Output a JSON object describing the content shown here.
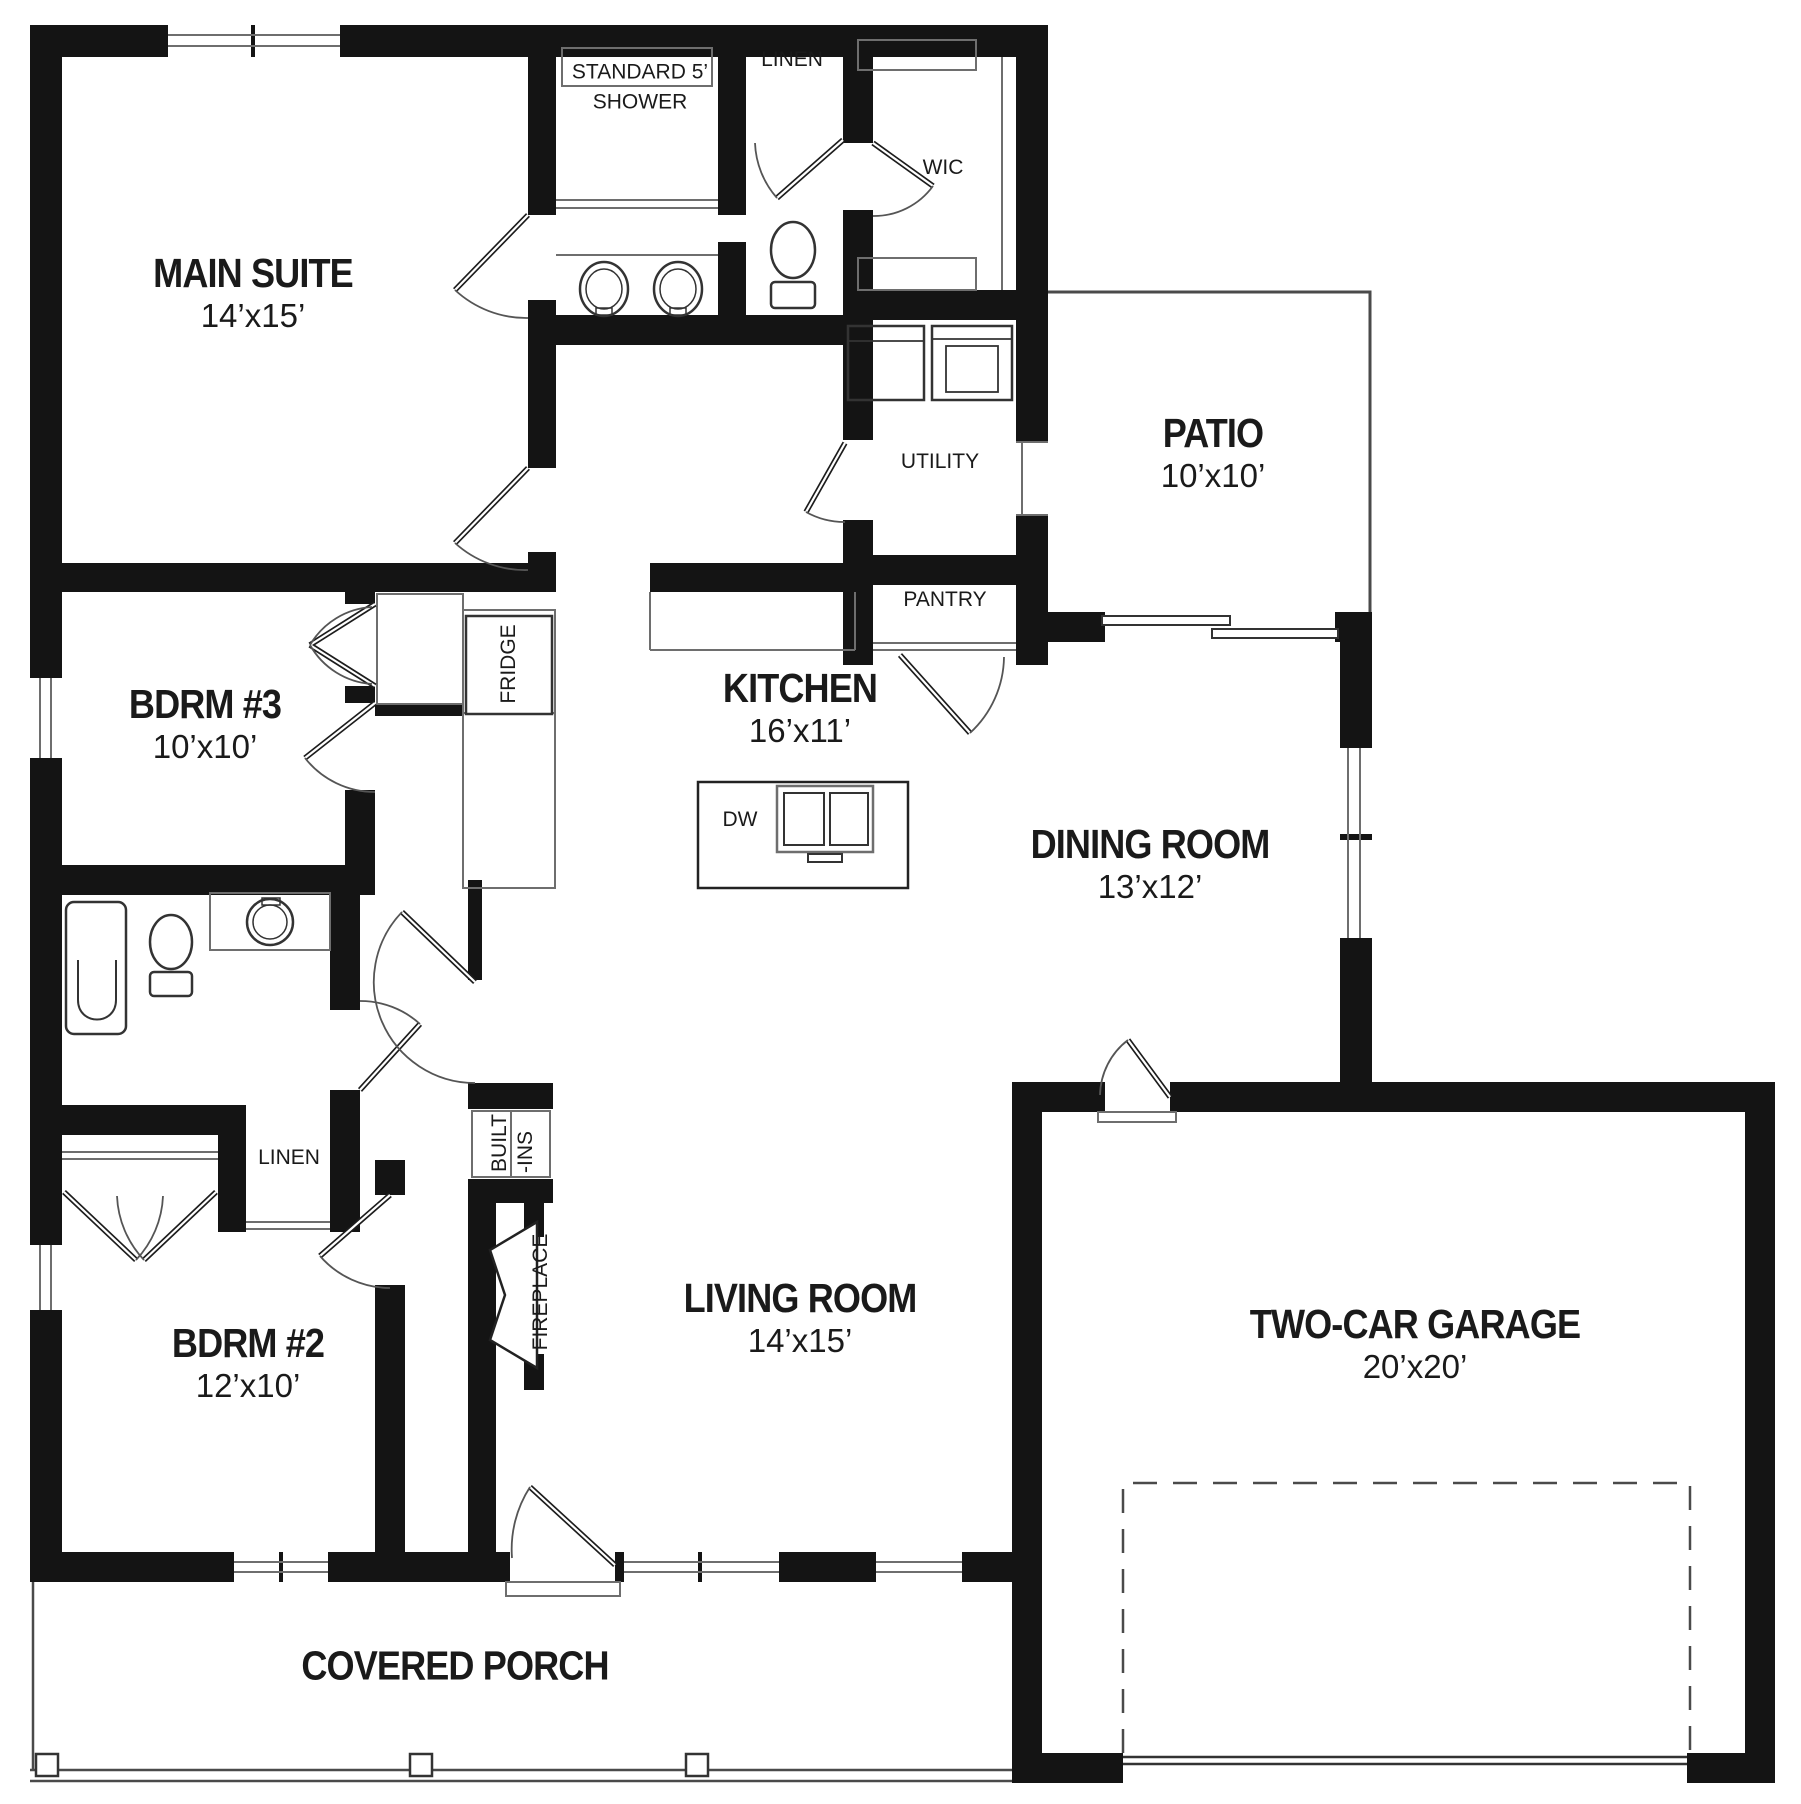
{
  "plan": {
    "rooms": [
      {
        "name": "MAIN SUITE",
        "dims": "14’x15’"
      },
      {
        "name": "BDRM #3",
        "dims": "10’x10’"
      },
      {
        "name": "BDRM #2",
        "dims": "12’x10’"
      },
      {
        "name": "KITCHEN",
        "dims": "16’x11’"
      },
      {
        "name": "DINING ROOM",
        "dims": "13’x12’"
      },
      {
        "name": "LIVING ROOM",
        "dims": "14’x15’"
      },
      {
        "name": "PATIO",
        "dims": "10’x10’"
      },
      {
        "name": "TWO-CAR GARAGE",
        "dims": "20’x20’"
      },
      {
        "name": "COVERED PORCH",
        "dims": ""
      }
    ],
    "labels": {
      "shower_line1": "STANDARD 5’",
      "shower_line2": "SHOWER",
      "linen_hall": "LINEN",
      "wic": "WIC",
      "utility": "UTILITY",
      "pantry": "PANTRY",
      "fridge": "FRIDGE",
      "dishwasher": "DW",
      "linen_bdrm": "LINEN",
      "built_line1": "BUILT",
      "built_line2": "-INS",
      "fireplace": "FIREPLACE"
    },
    "colors": {
      "walls": "#141414",
      "fixtures": "#6e6e6e",
      "text": "#1a1a1a",
      "background": "#ffffff"
    }
  }
}
